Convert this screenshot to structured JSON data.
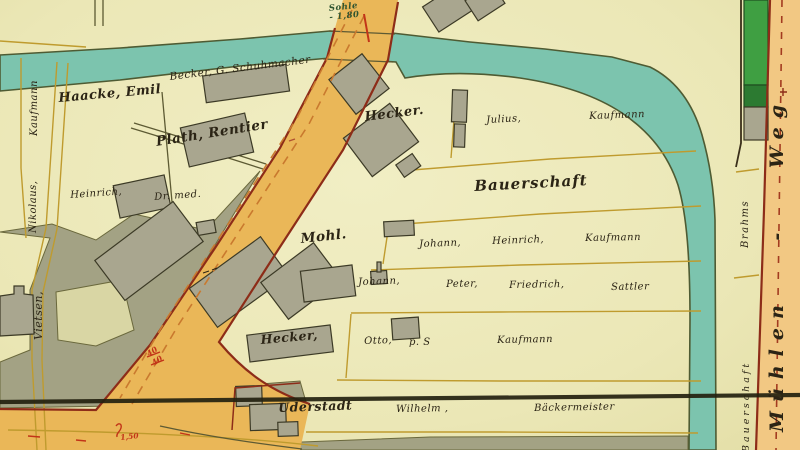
{
  "map": {
    "title": "historical cadastral map sheet",
    "waterway_note": {
      "line1": "Sohle",
      "line2": "- 1,80"
    },
    "labels": {
      "haacke": "Haacke, Emil",
      "becker": "Becker, G. Schuhmacher",
      "plath": "Plath, Rentier",
      "heinrich_name": "Heinrich,",
      "heinrich_title": "Dr. med.",
      "hecker_top": "Hecker.",
      "julius": "Julius,",
      "kaufmann_top": "Kaufmann",
      "bauerschaft": "Bauerschaft",
      "mohl": "Mohl.",
      "johann_a": "Johann,",
      "heinrich_a": "Heinrich,",
      "kaufmann_a": "Kaufmann",
      "johann_b": "Johann,",
      "peter_b": "Peter,",
      "friedrich_b": "Friedrich,",
      "sattler_b": "Sattler",
      "hecker_mid": "Hecker,",
      "otto": "Otto,",
      "p_s": "p. S",
      "kaufmann_c": "Kaufmann",
      "uderstadt": "Uderstadt",
      "wilhelm": "Wilhelm ,",
      "baeckermeister": "Bäckermeister",
      "kaufmann_left": "Kaufmann",
      "nikolaus_left": "Nikolaus,",
      "vietsen_left": "Vietsen,",
      "brahms_right": "Brahms",
      "muehlenweg": "Mühlen - Weg",
      "bauerschaft_right": "Bauerschaft",
      "measure_40a": "40",
      "measure_40b": "40",
      "measure_150": "1,50"
    },
    "colors": {
      "field": "#edeabc",
      "olive_parcel": "#a3a284",
      "water": "#7cc4ae",
      "road": "#eab758",
      "road_right": "#f2c883",
      "building": "#a9a68f",
      "green_strip": "#3f9f42",
      "green_dark": "#2c7a31",
      "red_edge": "#8d2c18",
      "black_line": "#23210f",
      "ink": "#2b2415",
      "red_ink": "#c23418",
      "green_ink": "#2f5430",
      "mustard_line": "#bf9b2e"
    }
  }
}
